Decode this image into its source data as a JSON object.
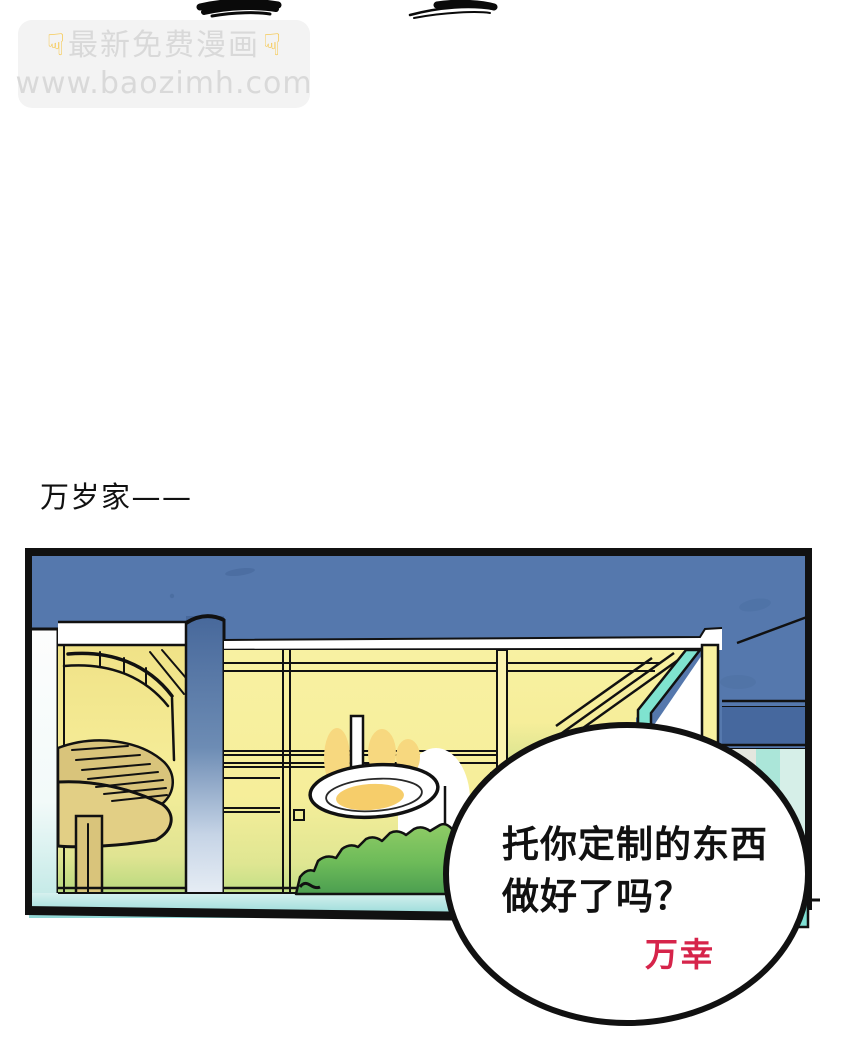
{
  "page": {
    "background_color": "#ffffff"
  },
  "watermark": {
    "hand_icon": "☟",
    "title": "最新免费漫画",
    "url": "www.baozimh.com",
    "box_color": "#f3f3f3",
    "text_color": "#d9d9d9",
    "hand_color": "#f6c544"
  },
  "caption": {
    "text": "万岁家——",
    "color": "#111111"
  },
  "panel": {
    "scene": "night exterior of a house with lit yellow windows, a spiral staircase, a hanging ceiling lamp, a green bush and teal ground under a dark blue sky",
    "colors": {
      "sky": "#5578ad",
      "window_yellow": "#f6ee9a",
      "staircase_tan": "#d9c47b",
      "ground_teal": "#9fdedd",
      "bush_green": "#76c257",
      "corner_teal": "#7fe3d0",
      "outline": "#111111"
    }
  },
  "speech_bubble": {
    "line1": "托你定制的东西",
    "line2": "做好了吗？",
    "speaker": "万幸",
    "fill": "#ffffff",
    "text_color": "#111111",
    "speaker_color": "#d6244a"
  }
}
